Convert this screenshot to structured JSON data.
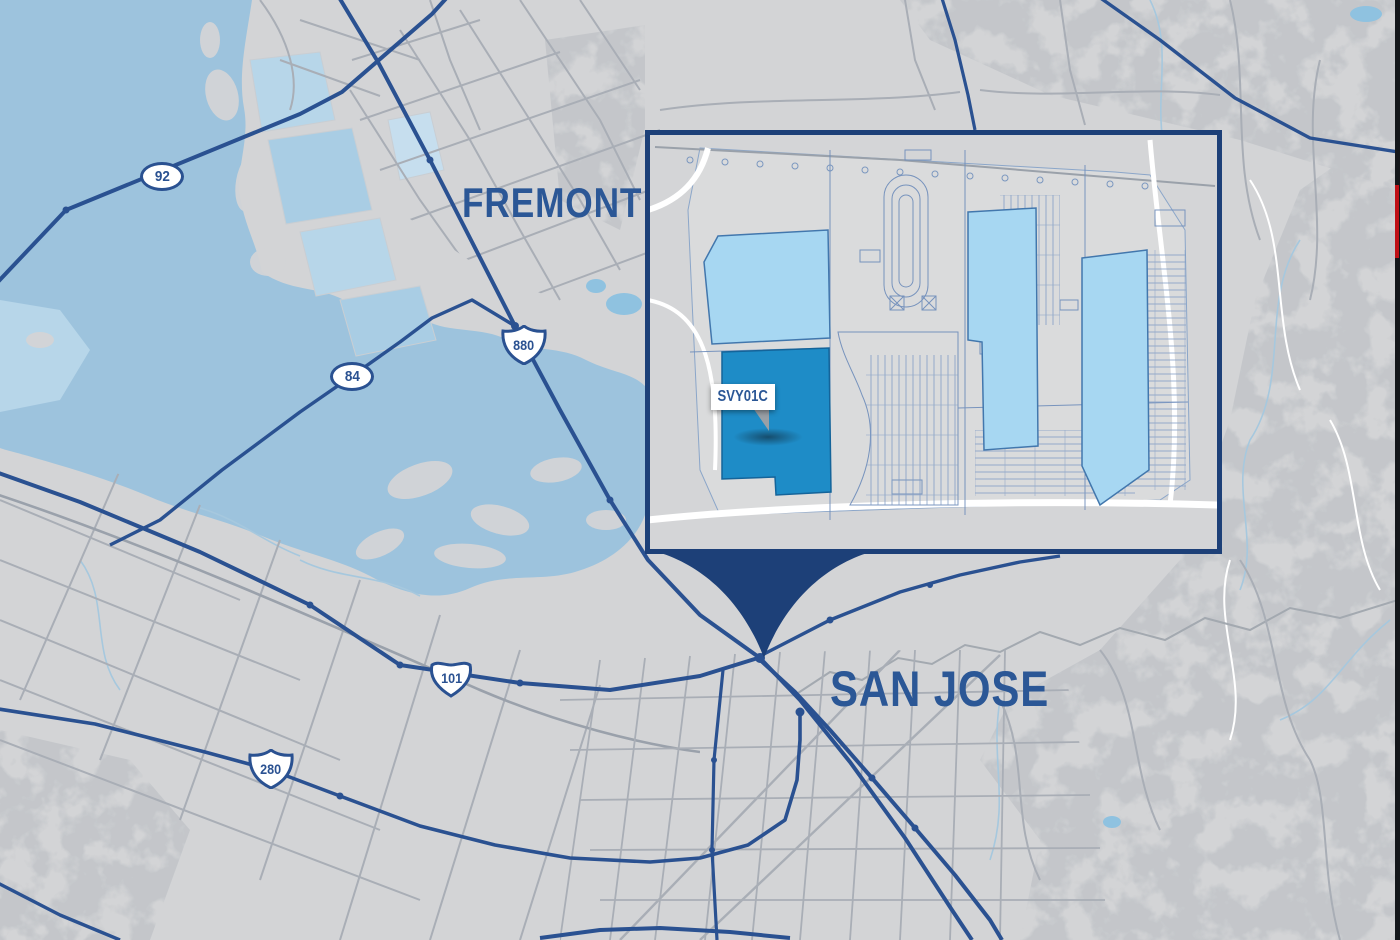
{
  "map": {
    "title": "SVY01C campus location map - South San Francisco Bay",
    "city_labels": [
      {
        "id": "fremont",
        "text": "FREMONT"
      },
      {
        "id": "san-jose",
        "text": "SAN JOSE"
      }
    ],
    "shields": [
      {
        "route": "92",
        "type": "state-oval"
      },
      {
        "route": "84",
        "type": "state-oval"
      },
      {
        "route": "880",
        "type": "interstate"
      },
      {
        "route": "101",
        "type": "us-route"
      },
      {
        "route": "280",
        "type": "interstate"
      }
    ],
    "colors": {
      "land": "#d3d4d6",
      "water": "#9dc3dd",
      "marsh": "#b9d7e9",
      "highway": "#2a5191",
      "minor_road": "#a9aeb6",
      "label_blue": "#2b5796",
      "inset_border": "#1d4078",
      "building_light": "#a7d7f2",
      "building_highlight": "#1e8cc7",
      "edge_red": "#bf1016"
    }
  },
  "inset": {
    "site_label": "SVY01C",
    "highlighted_building": "SVY01C",
    "light_buildings_count": 3
  }
}
